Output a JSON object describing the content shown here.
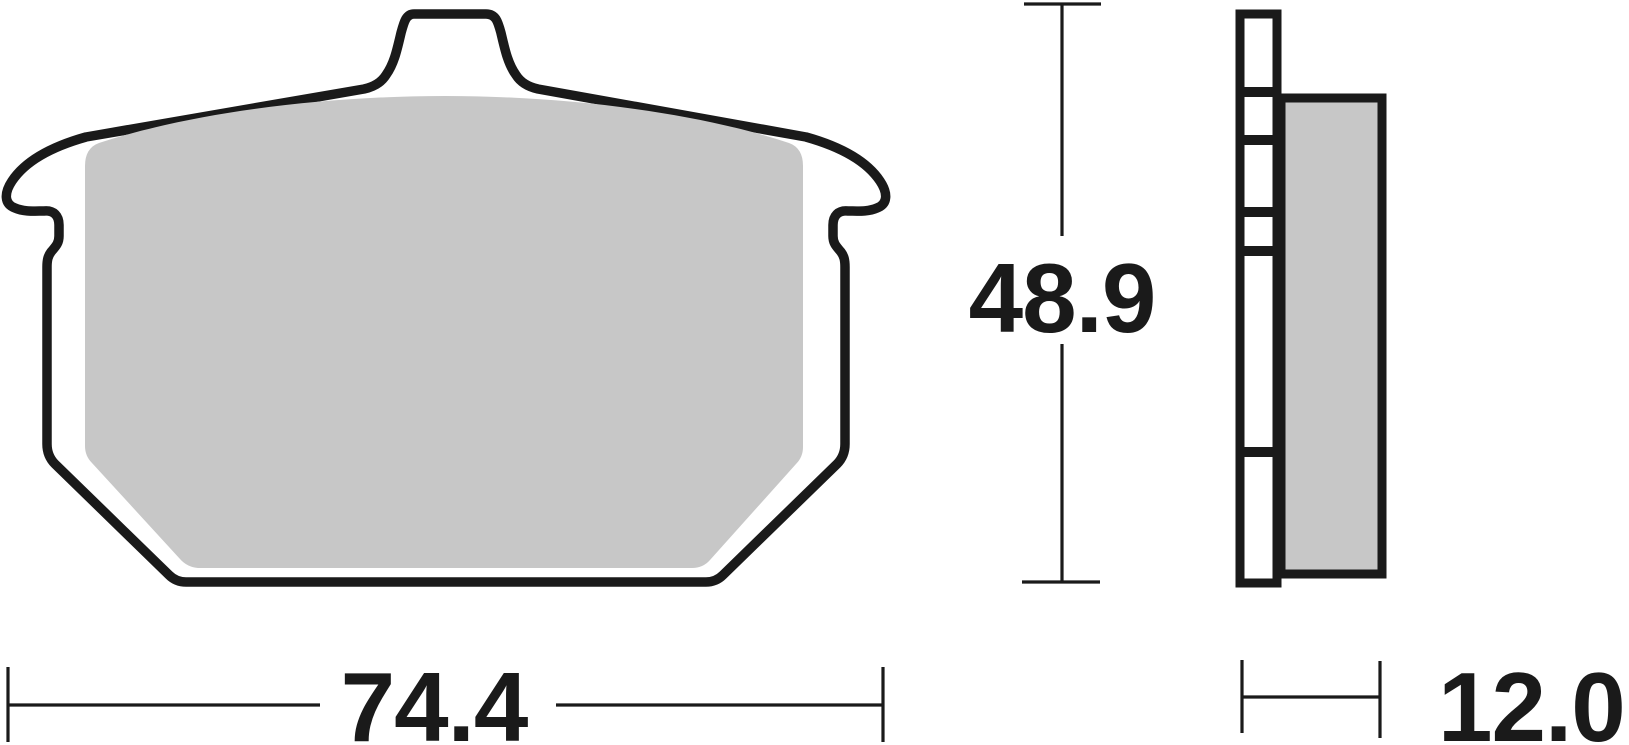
{
  "dimensions": {
    "width": {
      "value": "74.4"
    },
    "height": {
      "value": "48.9"
    },
    "thickness": {
      "value": "12.0"
    }
  },
  "colors": {
    "outline": "#1a1a1a",
    "friction_material": "#c7c7c7",
    "backing_plate": "#ffffff",
    "background": "#ffffff"
  }
}
